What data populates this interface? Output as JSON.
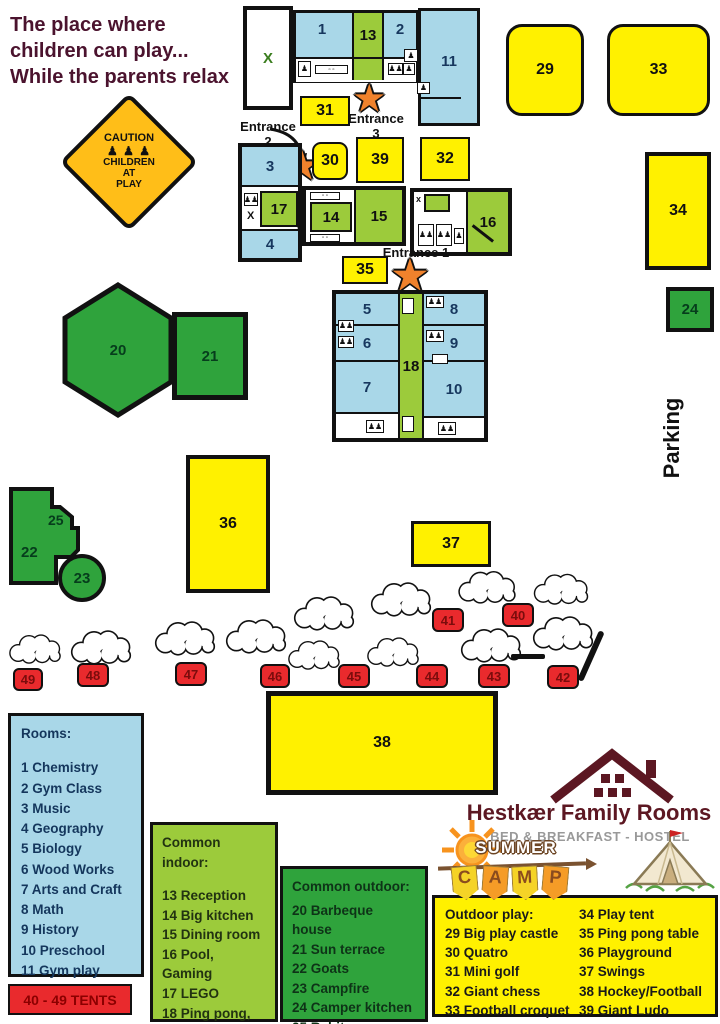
{
  "title": {
    "line1": "The place where",
    "line2": "children can play...",
    "line3": "While the parents relax"
  },
  "caution_sign": {
    "word": "CAUTION",
    "figures": "♟ ♟ ♟",
    "line1": "CHILDREN",
    "line2": "AT",
    "line3": "PLAY"
  },
  "map": {
    "labels": {
      "r1": "1",
      "r2": "2",
      "r3": "3",
      "r4": "4",
      "r5": "5",
      "r6": "6",
      "r7": "7",
      "r8": "8",
      "r9": "9",
      "r10": "10",
      "r11": "11",
      "r13": "13",
      "r14": "14",
      "r15": "15",
      "r16": "16",
      "r17": "17",
      "r18": "18",
      "r20": "20",
      "r21": "21",
      "r22": "22",
      "r23": "23",
      "r24": "24",
      "r25": "25",
      "r29": "29",
      "r30": "30",
      "r31": "31",
      "r32": "32",
      "r33": "33",
      "r34": "34",
      "r35": "35",
      "r36": "36",
      "r37": "37",
      "r38": "38",
      "r39": "39",
      "r40": "40",
      "r41": "41",
      "r42": "42",
      "r43": "43",
      "r44": "44",
      "r45": "45",
      "r46": "46",
      "r47": "47",
      "r48": "48",
      "r49": "49"
    },
    "x_mark": "X",
    "x_small": "x",
    "parking": "Parking"
  },
  "entrances": {
    "e1": "Entrance 1",
    "e2_line1": "Entrance",
    "e2_line2": "2",
    "e3_line1": "Entrance",
    "e3_line2": "3"
  },
  "icons": {
    "star": "★",
    "family": "♟♟",
    "person": "♟",
    "counter": "▫ ▫"
  },
  "legend_rooms": {
    "title": "Rooms:",
    "items": [
      "1 Chemistry",
      "2 Gym Class",
      "3 Music",
      "4 Geography",
      "5 Biology",
      "6 Wood Works",
      "7 Arts and Craft",
      "8 Math",
      "9 History",
      "10 Preschool",
      "11 Gym play room"
    ]
  },
  "legend_tents": {
    "label": "40 - 49 TENTS"
  },
  "legend_common_indoor": {
    "title": "Common indoor:",
    "items": [
      "13 Reception",
      "14 Big kitchen",
      "15 Dining room",
      "16 Pool, Gaming",
      "17 LEGO",
      "18 Ping pong, Wii LEGO and toys"
    ]
  },
  "legend_common_outdoor": {
    "title": "Common outdoor:",
    "items": [
      "20 Barbeque house",
      "21 Sun terrace",
      "22 Goats",
      "23 Campfire",
      "24 Camper kitchen",
      "25 Rabits"
    ]
  },
  "legend_outdoor_play": {
    "title": "Outdoor play:",
    "left": [
      "29 Big play castle",
      "30 Quatro",
      "31 Mini golf",
      "32 Giant chess",
      "33 Football croquet"
    ],
    "right": [
      "34 Play tent",
      "35 Ping pong table",
      "36 Playground",
      "37 Swings",
      "38 Hockey/Football",
      "39 Giant Ludo"
    ]
  },
  "logo": {
    "name": "Hestkær Family Rooms",
    "subtitle": "BED & BREAKFAST - HOSTEL",
    "camp_word": "SUMMER",
    "camp_letters": [
      "C",
      "A",
      "M",
      "P"
    ]
  },
  "colors": {
    "room_blue": "#A9D7E8",
    "room_green": "#9CCB3B",
    "shape_green": "#2FA33C",
    "box_yellow": "#FFF100",
    "tent_red": "#E92A2D",
    "title_maroon": "#4B132E",
    "logo_maroon": "#5C1722"
  }
}
